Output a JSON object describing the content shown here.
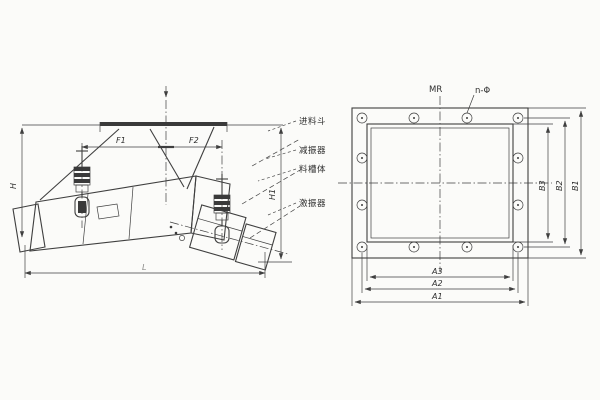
{
  "drawing": {
    "title": "vibrating-feeder-technical-drawing",
    "background": "#fbfbf9",
    "ink_color": "#3f3f3f",
    "left_view": {
      "view_name": "feeder-side-view",
      "feed_direction_marker": "feed-arrow",
      "dims": {
        "h_left": "H",
        "h_right": "H1",
        "f1": "F1",
        "f2": "F2",
        "length": "L"
      },
      "callouts": [
        {
          "label": "进料斗"
        },
        {
          "label": "减振器"
        },
        {
          "label": "料槽体"
        },
        {
          "label": "激振器"
        }
      ]
    },
    "right_view": {
      "view_name": "mounting-flange-view",
      "note_top": "MR",
      "hole_note": "n-Φ",
      "bolt_count": 12,
      "dims": {
        "a1": "A1",
        "a2": "A2",
        "a3": "A3",
        "b1": "B1",
        "b2": "B2",
        "b3": "B3"
      }
    }
  }
}
